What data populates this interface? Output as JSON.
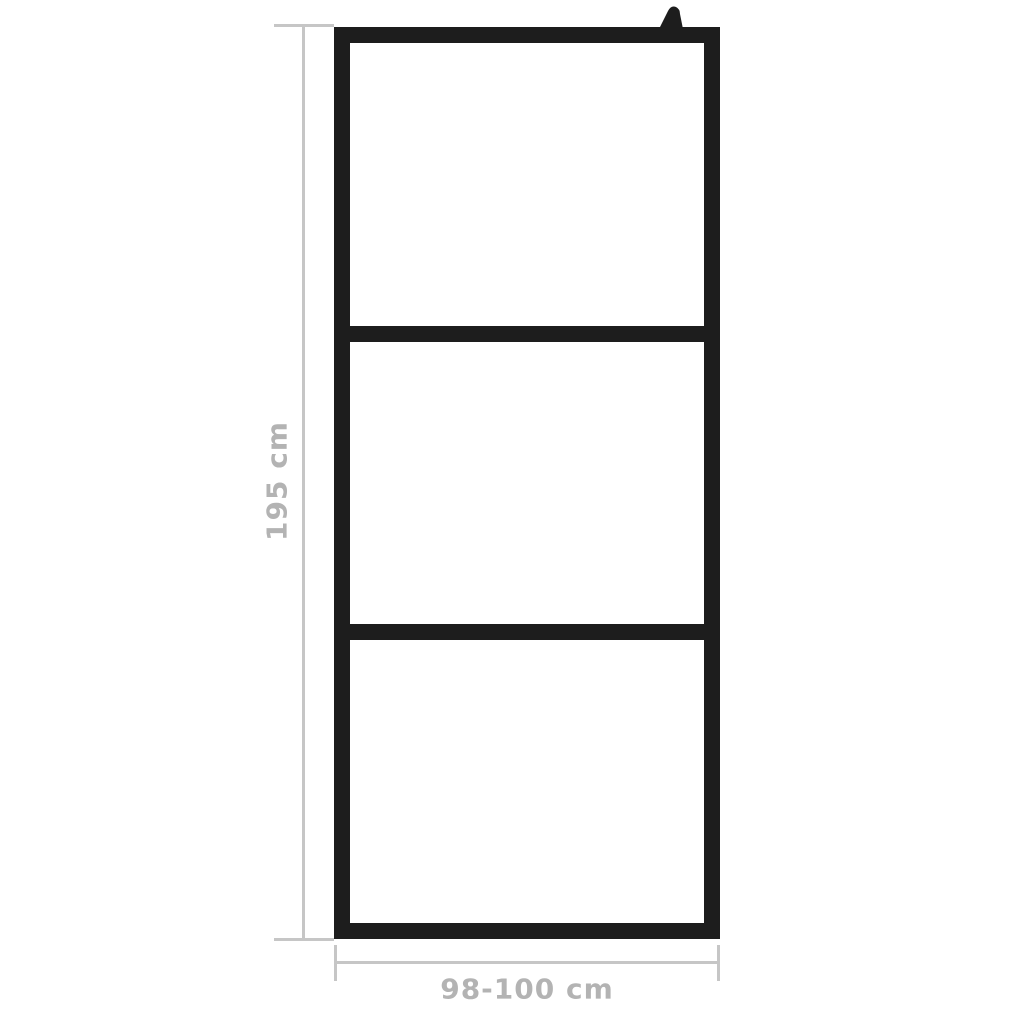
{
  "diagram": {
    "kind": "product-dimension-diagram",
    "dimensions": {
      "height": {
        "label": "195 cm"
      },
      "width": {
        "label": "98-100 cm"
      }
    },
    "frame": {
      "panel_count": 3,
      "crossbar_count": 2,
      "has_wall_bracket": true
    }
  },
  "colors": {
    "frame_black": "#1d1d1d",
    "dimension_line": "#c6c6c6",
    "dimension_text": "#b3b3b3",
    "background": "#ffffff"
  }
}
